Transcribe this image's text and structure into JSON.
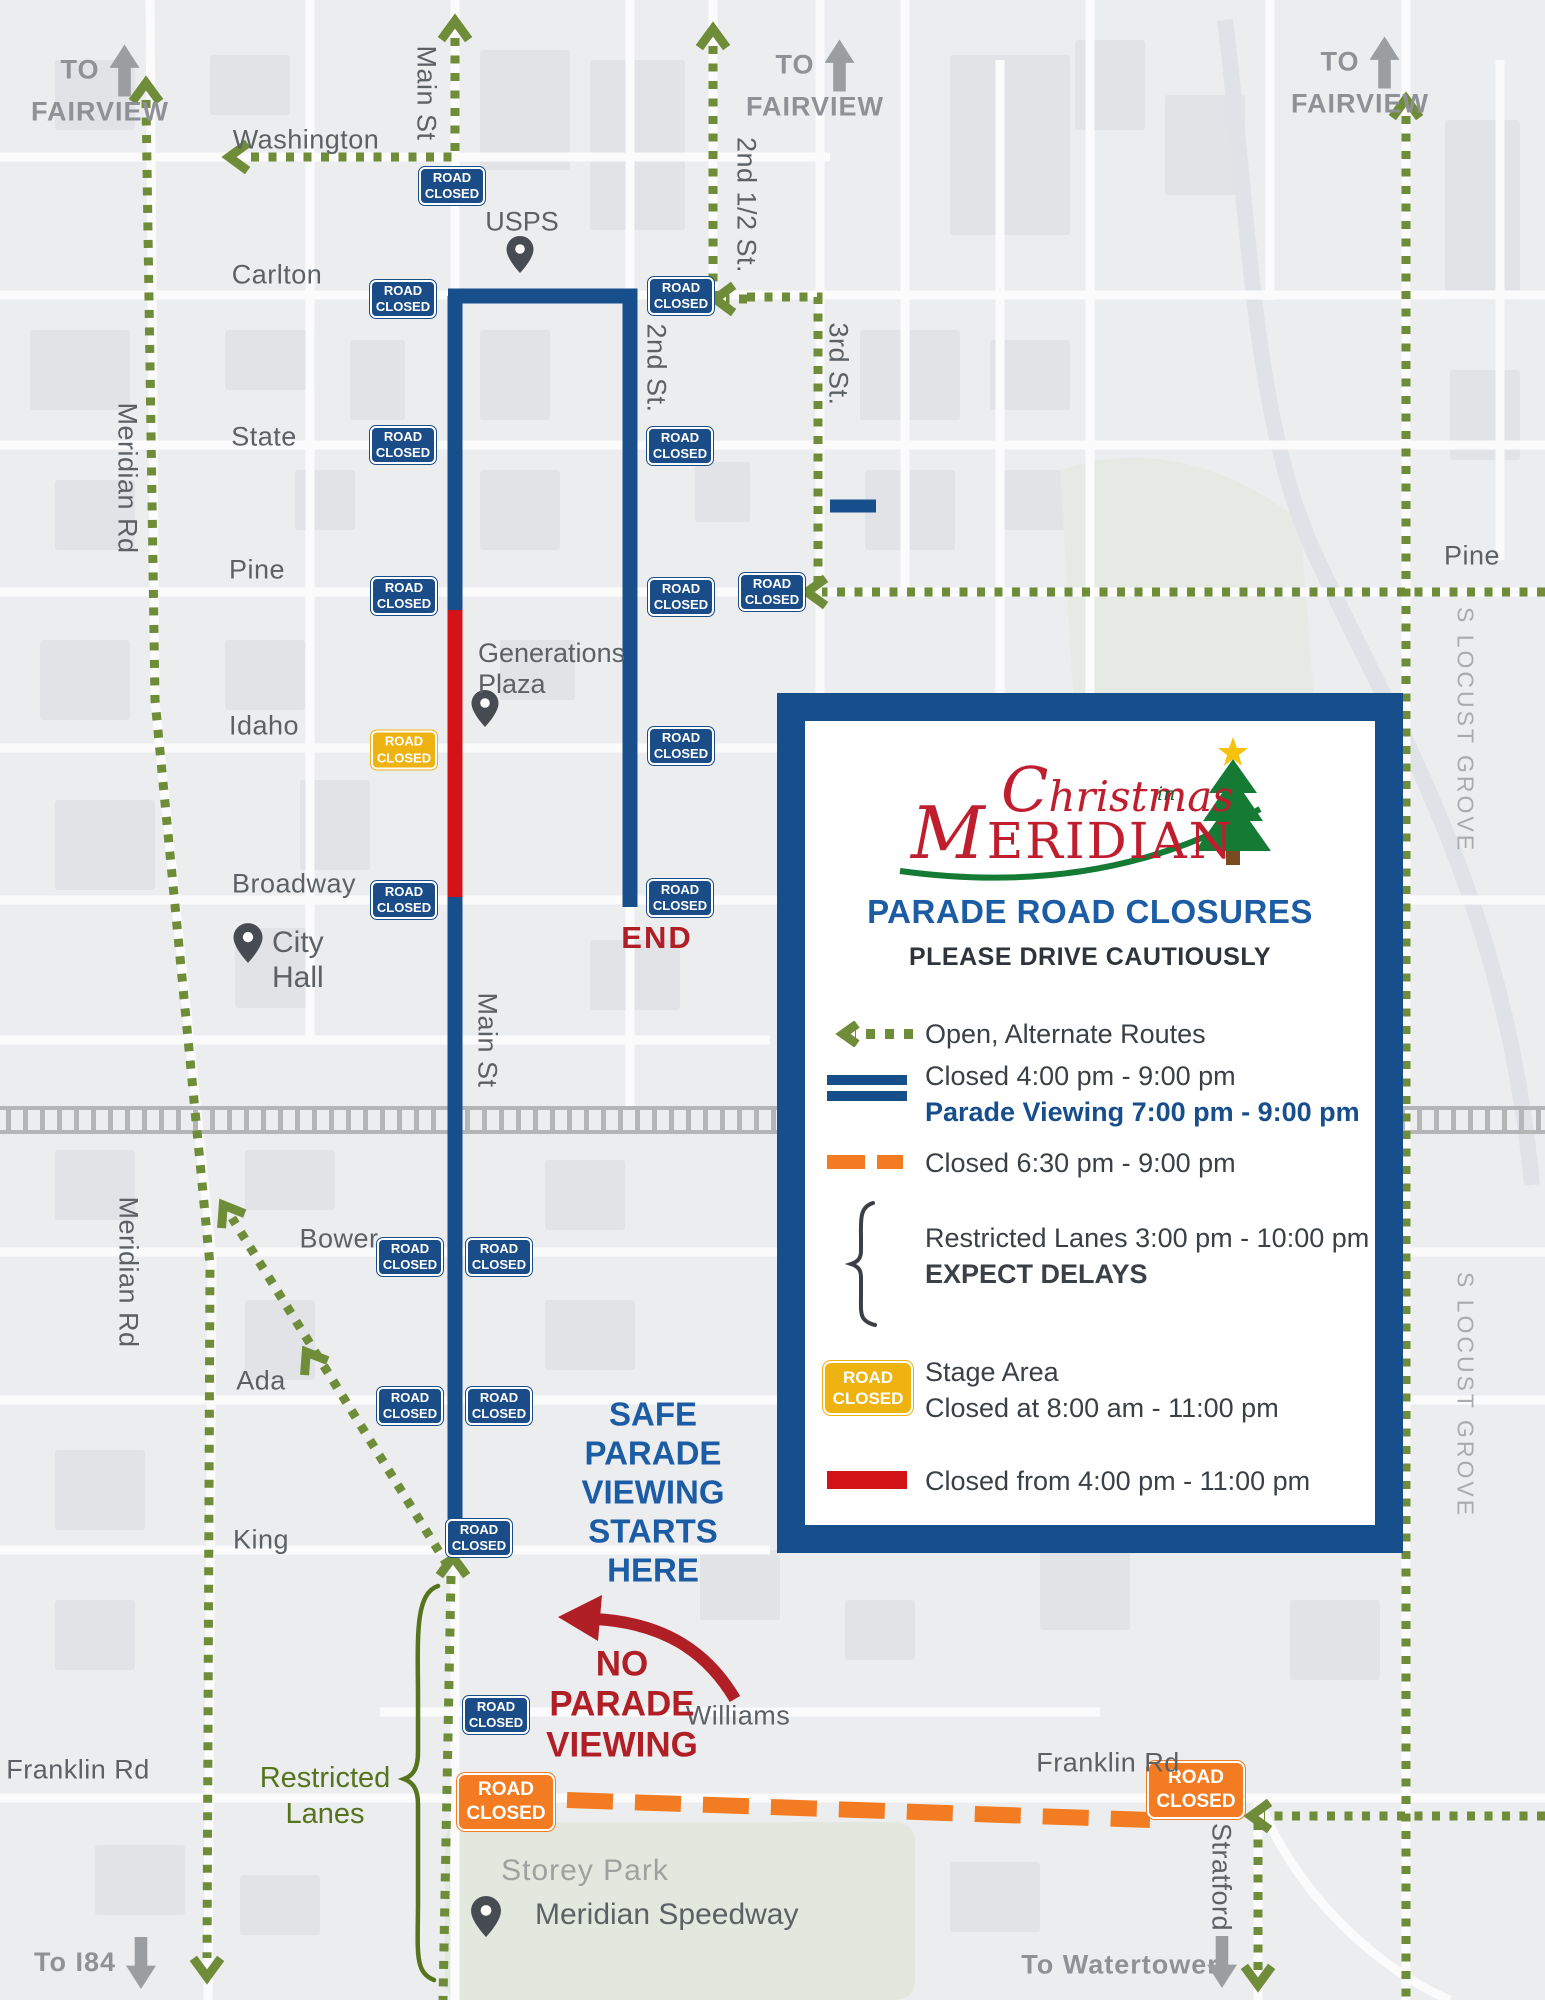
{
  "badges": {
    "blue": {
      "line1": "ROAD",
      "line2": "CLOSED"
    },
    "orange": {
      "line1": "ROAD",
      "line2": "CLOSED"
    },
    "yellow": {
      "line1": "ROAD",
      "line2": "CLOSED"
    }
  },
  "directions": {
    "fairview_left": {
      "to": "TO",
      "name": "FAIRVIEW"
    },
    "fairview_mid": {
      "to": "TO",
      "name": "FAIRVIEW"
    },
    "fairview_right": {
      "to": "TO",
      "name": "FAIRVIEW"
    },
    "i84": "To I84",
    "watertower": "To Watertower"
  },
  "streets": {
    "washington": "Washington",
    "carlton": "Carlton",
    "state": "State",
    "pine_left": "Pine",
    "pine_right": "Pine",
    "idaho": "Idaho",
    "broadway": "Broadway",
    "bower": "Bower",
    "ada": "Ada",
    "king": "King",
    "williams": "Williams",
    "franklin_left": "Franklin Rd",
    "franklin_right": "Franklin Rd",
    "main_top": "Main St",
    "main_mid": "Main St",
    "meridian_top": "Meridian Rd",
    "meridian_bottom": "Meridian Rd",
    "second_half": "2nd 1/2 St.",
    "second": "2nd St.",
    "third": "3rd St.",
    "locust_top": "S LOCUST GROVE",
    "locust_bottom": "S LOCUST GROVE",
    "stratford": "Stratford"
  },
  "pois": {
    "usps": "USPS",
    "generations_plaza": "Generations\nPlaza",
    "city_hall": "City\nHall",
    "storey_park": "Storey Park",
    "speedway": "Meridian Speedway"
  },
  "annotations": {
    "end": "END",
    "safe_viewing": "SAFE\nPARADE\nVIEWING\nSTARTS\nHERE",
    "no_viewing": "NO\nPARADE\nVIEWING",
    "restricted_lanes": "Restricted\nLanes"
  },
  "legend": {
    "logo": {
      "christmas": "Christmas",
      "in": "in",
      "meridian": "MERIDIAN"
    },
    "title": "PARADE ROAD CLOSURES",
    "subtitle": "PLEASE DRIVE CAUTIOUSLY",
    "open_label": "Open, Alternate Routes",
    "closed_blue_1": "Closed 4:00 pm - 9:00 pm",
    "closed_blue_2": "Parade Viewing 7:00 pm - 9:00 pm",
    "closed_orange": "Closed 6:30 pm - 9:00 pm",
    "restricted_1": "Restricted Lanes 3:00 pm - 10:00 pm",
    "restricted_2": "EXPECT DELAYS",
    "stage_1": "Stage Area",
    "stage_2": "Closed at 8:00 am - 11:00 pm",
    "closed_red": "Closed from 4:00 pm - 11:00 pm"
  },
  "colors": {
    "route_blue": "#174f8c",
    "route_red": "#d31317",
    "route_orange": "#f37b21",
    "route_green": "#6f8c38",
    "stage_yellow": "#eeb211",
    "text_blue": "#1c5ca4",
    "text_red": "#b01f26",
    "text_green": "#55741d"
  }
}
